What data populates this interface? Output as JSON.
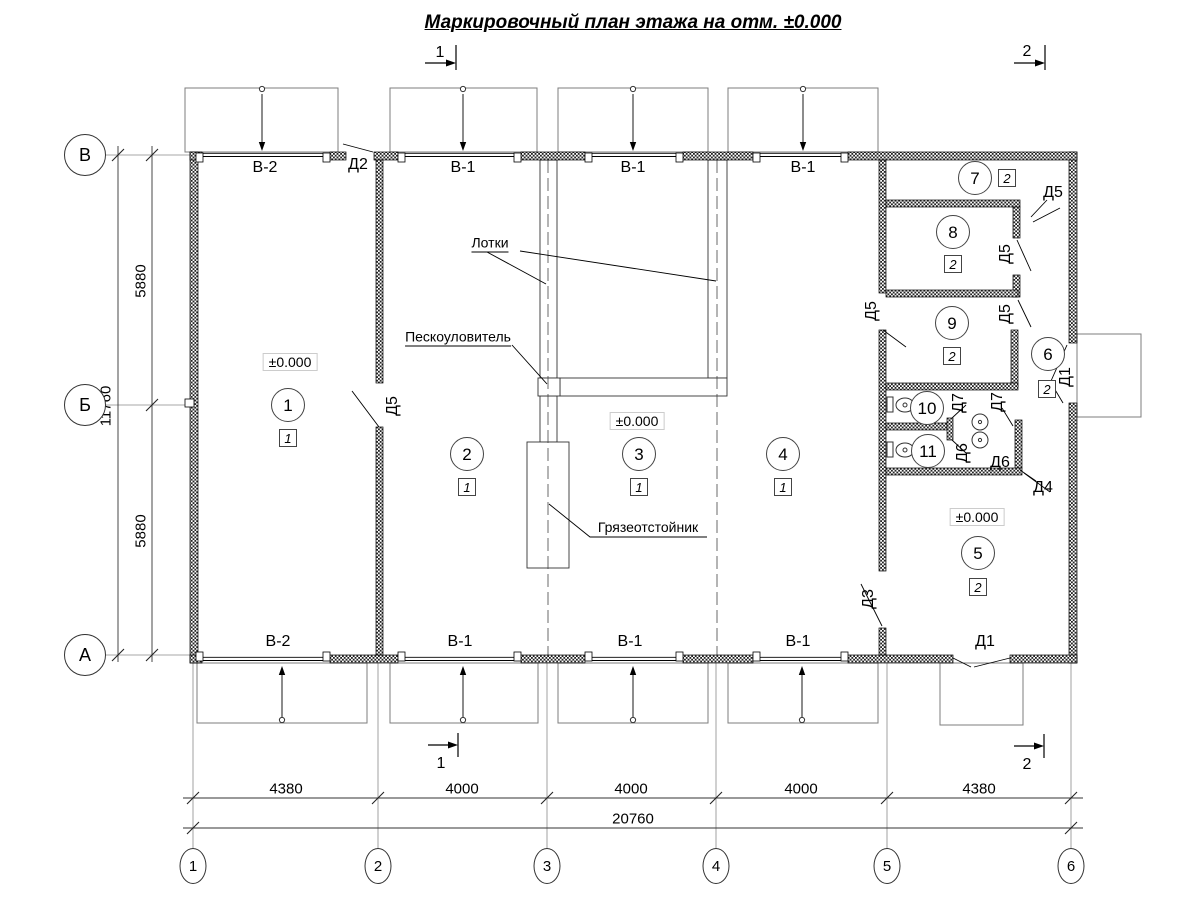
{
  "title": "Маркировочный план этажа на отм. ±0.000",
  "drawing_type": "floor-plan",
  "section_marks": [
    {
      "name": "section-mark-1-top",
      "text": "1",
      "x": 440,
      "y": 53
    },
    {
      "name": "section-mark-2-top",
      "text": "2",
      "x": 1027,
      "y": 52
    },
    {
      "name": "section-mark-1-bottom",
      "text": "1",
      "x": 441,
      "y": 764
    },
    {
      "name": "section-mark-2-bottom",
      "text": "2",
      "x": 1027,
      "y": 765
    }
  ],
  "gate_labels": [
    {
      "name": "gate-label-v2-top",
      "text": "В-2",
      "x": 265,
      "y": 168
    },
    {
      "name": "gate-label-v1-top-1",
      "text": "В-1",
      "x": 463,
      "y": 168
    },
    {
      "name": "gate-label-v1-top-2",
      "text": "В-1",
      "x": 633,
      "y": 168
    },
    {
      "name": "gate-label-v1-top-3",
      "text": "В-1",
      "x": 803,
      "y": 168
    },
    {
      "name": "door-label-d2-top",
      "text": "Д2",
      "x": 358,
      "y": 165
    },
    {
      "name": "gate-label-v2-bottom",
      "text": "В-2",
      "x": 278,
      "y": 642
    },
    {
      "name": "gate-label-v1-bottom-1",
      "text": "В-1",
      "x": 460,
      "y": 642
    },
    {
      "name": "gate-label-v1-bottom-2",
      "text": "В-1",
      "x": 630,
      "y": 642
    },
    {
      "name": "gate-label-v1-bottom-3",
      "text": "В-1",
      "x": 798,
      "y": 642
    },
    {
      "name": "door-label-d1-bottom",
      "text": "Д1",
      "x": 985,
      "y": 642
    }
  ],
  "door_labels": [
    {
      "name": "door-label-d5-axis2",
      "text": "Д5",
      "x": 393,
      "y": 406,
      "rot": true
    },
    {
      "name": "door-label-d5-room9-left",
      "text": "Д5",
      "x": 872,
      "y": 311,
      "rot": true
    },
    {
      "name": "door-label-d5-room7",
      "text": "Д5",
      "x": 1053,
      "y": 193
    },
    {
      "name": "door-label-d5-room8",
      "text": "Д5",
      "x": 1006,
      "y": 254,
      "rot": true
    },
    {
      "name": "door-label-d5-room9-right",
      "text": "Д5",
      "x": 1006,
      "y": 314,
      "rot": true
    },
    {
      "name": "door-label-d7-1",
      "text": "Д7",
      "x": 959,
      "y": 403,
      "rot": true
    },
    {
      "name": "door-label-d7-2",
      "text": "Д7",
      "x": 998,
      "y": 402,
      "rot": true
    },
    {
      "name": "door-label-d6-1",
      "text": "Д6",
      "x": 963,
      "y": 453,
      "rot": true
    },
    {
      "name": "door-label-d6-2",
      "text": "Д6",
      "x": 1000,
      "y": 463
    },
    {
      "name": "door-label-d4",
      "text": "Д4",
      "x": 1043,
      "y": 488
    },
    {
      "name": "door-label-d3",
      "text": "Д3",
      "x": 869,
      "y": 599,
      "rot": true
    },
    {
      "name": "door-label-d1-right",
      "text": "Д1",
      "x": 1066,
      "y": 377,
      "rot": true
    }
  ],
  "annotations": [
    {
      "name": "annotation-trays",
      "text": "Лотки",
      "x": 490,
      "y": 244,
      "underline": true
    },
    {
      "name": "annotation-sand-trap",
      "text": "Пескоуловитель",
      "x": 458,
      "y": 338,
      "underline": true
    },
    {
      "name": "annotation-mud-settler",
      "text": "Грязеотстойник",
      "x": 648,
      "y": 527,
      "underline": false
    }
  ],
  "elevation_marks": [
    {
      "name": "elevation-room1",
      "text": "±0.000",
      "x": 290,
      "y": 362
    },
    {
      "name": "elevation-room3",
      "text": "±0.000",
      "x": 637,
      "y": 421
    },
    {
      "name": "elevation-room5",
      "text": "±0.000",
      "x": 977,
      "y": 517
    }
  ],
  "rooms": [
    {
      "name": "room-1",
      "num": "1",
      "x": 288,
      "y": 405,
      "cat": "1",
      "sx": 288,
      "sy": 438
    },
    {
      "name": "room-2",
      "num": "2",
      "x": 467,
      "y": 454,
      "cat": "1",
      "sx": 467,
      "sy": 487
    },
    {
      "name": "room-3",
      "num": "3",
      "x": 639,
      "y": 454,
      "cat": "1",
      "sx": 639,
      "sy": 487
    },
    {
      "name": "room-4",
      "num": "4",
      "x": 783,
      "y": 454,
      "cat": "1",
      "sx": 783,
      "sy": 487
    },
    {
      "name": "room-5",
      "num": "5",
      "x": 978,
      "y": 553,
      "cat": "2",
      "sx": 978,
      "sy": 587
    },
    {
      "name": "room-6",
      "num": "6",
      "x": 1048,
      "y": 354,
      "cat": "2",
      "sx": 1047,
      "sy": 389
    },
    {
      "name": "room-7",
      "num": "7",
      "x": 975,
      "y": 178,
      "cat": "2",
      "sx": 1007,
      "sy": 178
    },
    {
      "name": "room-8",
      "num": "8",
      "x": 953,
      "y": 232,
      "cat": "2",
      "sx": 953,
      "sy": 264
    },
    {
      "name": "room-9",
      "num": "9",
      "x": 952,
      "y": 323,
      "cat": "2",
      "sx": 952,
      "sy": 356
    },
    {
      "name": "room-10",
      "num": "10",
      "x": 927,
      "y": 408
    },
    {
      "name": "room-11",
      "num": "11",
      "x": 928,
      "y": 451
    }
  ],
  "axes": {
    "left": [
      {
        "name": "axis-V",
        "text": "В",
        "x": 85,
        "y": 155
      },
      {
        "name": "axis-B",
        "text": "Б",
        "x": 85,
        "y": 405
      },
      {
        "name": "axis-A",
        "text": "А",
        "x": 85,
        "y": 655
      }
    ],
    "bottom": [
      {
        "name": "axis-1",
        "text": "1",
        "x": 193,
        "y": 866
      },
      {
        "name": "axis-2",
        "text": "2",
        "x": 378,
        "y": 866
      },
      {
        "name": "axis-3",
        "text": "3",
        "x": 547,
        "y": 866
      },
      {
        "name": "axis-4",
        "text": "4",
        "x": 716,
        "y": 866
      },
      {
        "name": "axis-5",
        "text": "5",
        "x": 887,
        "y": 866
      },
      {
        "name": "axis-6",
        "text": "6",
        "x": 1071,
        "y": 866
      }
    ]
  },
  "dimensions": [
    {
      "name": "dim-5880-top",
      "text": "5880",
      "x": 141,
      "y": 281,
      "rot": true
    },
    {
      "name": "dim-5880-bottom",
      "text": "5880",
      "x": 141,
      "y": 531,
      "rot": true
    },
    {
      "name": "dim-11760",
      "text": "11760",
      "x": 106,
      "y": 406,
      "rot": true
    },
    {
      "name": "dim-4380-left",
      "text": "4380",
      "x": 286,
      "y": 789
    },
    {
      "name": "dim-4000-1",
      "text": "4000",
      "x": 462,
      "y": 789
    },
    {
      "name": "dim-4000-2",
      "text": "4000",
      "x": 631,
      "y": 789
    },
    {
      "name": "dim-4000-3",
      "text": "4000",
      "x": 801,
      "y": 789
    },
    {
      "name": "dim-4380-right",
      "text": "4380",
      "x": 979,
      "y": 789
    },
    {
      "name": "dim-20760",
      "text": "20760",
      "x": 633,
      "y": 819
    }
  ]
}
